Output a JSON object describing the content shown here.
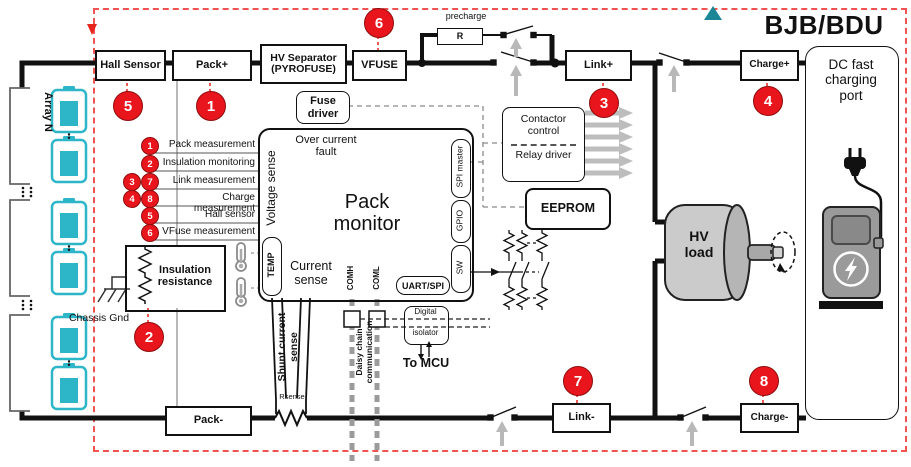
{
  "header": {
    "title": "BJB/BDU"
  },
  "legend": {
    "items": [
      {
        "nums": [
          "1"
        ],
        "label": "Pack measurement"
      },
      {
        "nums": [
          "2"
        ],
        "label": "Insulation monitoring"
      },
      {
        "nums": [
          "3",
          "7"
        ],
        "label": "Link measurement"
      },
      {
        "nums": [
          "4",
          "8"
        ],
        "label": "Charge measurement"
      },
      {
        "nums": [
          "5"
        ],
        "label": "Hall sensor"
      },
      {
        "nums": [
          "6"
        ],
        "label": "VFuse measurement"
      }
    ]
  },
  "markers": {
    "m1": "1",
    "m2": "2",
    "m3": "3",
    "m4": "4",
    "m5": "5",
    "m6": "6",
    "m7": "7",
    "m8": "8"
  },
  "blocks": {
    "hall_sensor": "Hall Sensor",
    "pack_plus": "Pack+",
    "hv_separator": "HV Separator (PYROFUSE)",
    "vfuse": "VFUSE",
    "precharge": "precharge",
    "precharge_resistor": "R",
    "link_plus": "Link+",
    "charge_plus": "Charge+",
    "dc_port": "DC fast charging port",
    "fuse_driver": "Fuse driver",
    "over_current_fault": "Over current fault",
    "pack_monitor": "Pack monitor",
    "voltage_sense": "Voltage sense",
    "current_sense": "Current sense",
    "temp": "TEMP",
    "comh": "COMH",
    "coml": "COML",
    "uart_spi": "UART/SPI",
    "sw": "SW",
    "gpio": "GPIO",
    "spi_master": "SPI master",
    "contactor_control": "Contactor control",
    "relay_driver": "Relay driver",
    "eeprom": "EEPROM",
    "hv_load": "HV load",
    "insulation_resistance": "Insulation resistance",
    "chassis_gnd": "Chassis Gnd",
    "array_n": "Array N",
    "pack_minus": "Pack-",
    "link_minus": "Link-",
    "charge_minus": "Charge-",
    "shunt_current_sense": "Shunt current sense",
    "rsense": "Rsense",
    "daisy_chain": "Daisy chain communication",
    "digital": "Digital",
    "isolator": "isolator",
    "to_mcu": "To MCU"
  },
  "colors": {
    "marker_red": "#e8151d",
    "border_red": "#f15353",
    "battery_teal": "#2cb6c8",
    "triangle_teal": "#1b8796",
    "arrow_gray": "#b8b8b8"
  }
}
